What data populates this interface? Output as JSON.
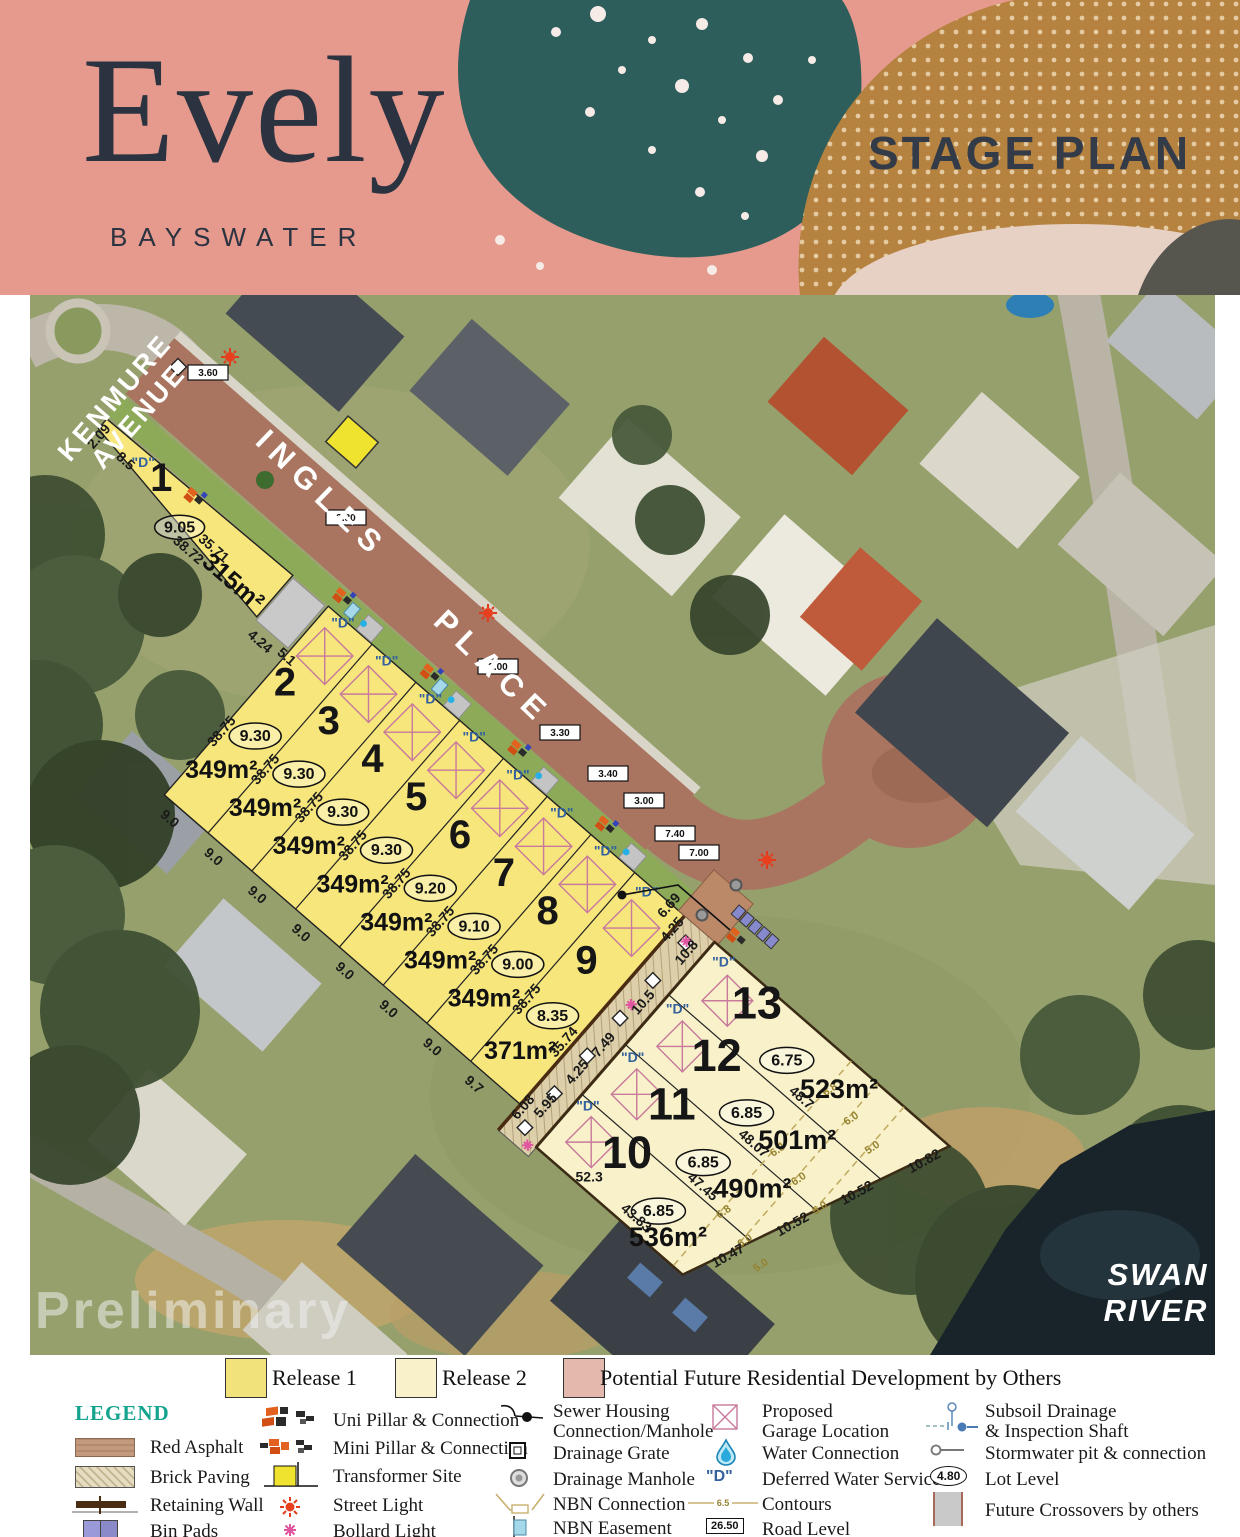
{
  "header": {
    "brand": "Evely",
    "suburb": "BAYSWATER",
    "plan_title": "STAGE PLAN"
  },
  "map": {
    "streets": {
      "kenmure_l1": "KENMURE",
      "kenmure_l2": "AVENUE",
      "ingles": "INGLES",
      "place": "PLACE"
    },
    "river_l1": "SWAN",
    "river_l2": "RIVER",
    "watermark": "Preliminary",
    "dws": "\"D\"",
    "road_levels": [
      "3.60",
      "3.30",
      "3.00",
      "3.30",
      "3.40",
      "3.00",
      "7.40",
      "7.00"
    ],
    "contours": [
      "6.8",
      "6.0",
      "5.0"
    ],
    "lots": [
      {
        "n": "1",
        "area": "315m²",
        "level": "9.05",
        "d1": "2.09",
        "d2": "8.5",
        "d3": "35.71",
        "d4": "38.72"
      },
      {
        "n": "2",
        "area": "349m²",
        "level": "9.30",
        "side": "38.75",
        "rear": "9.0"
      },
      {
        "n": "3",
        "area": "349m²",
        "level": "9.30",
        "side": "38.75",
        "rear": "9.0"
      },
      {
        "n": "4",
        "area": "349m²",
        "level": "9.30",
        "side": "38.75",
        "rear": "9.0"
      },
      {
        "n": "5",
        "area": "349m²",
        "level": "9.30",
        "side": "38.75",
        "rear": "9.0"
      },
      {
        "n": "6",
        "area": "349m²",
        "level": "9.20",
        "side": "38.75",
        "rear": "9.0"
      },
      {
        "n": "7",
        "area": "349m²",
        "level": "9.10",
        "side": "38.75",
        "rear": "9.0"
      },
      {
        "n": "8",
        "area": "349m²",
        "level": "9.00",
        "side": "38.75",
        "rear": "9.0"
      },
      {
        "n": "9",
        "area": "371m²",
        "level": "8.35",
        "side": "38.75",
        "side2": "35.74",
        "rear": "9.7"
      },
      {
        "n": "10",
        "area": "536m²",
        "level": "6.85",
        "len": "43.83",
        "end": "10.47",
        "side": "52.3"
      },
      {
        "n": "11",
        "area": "490m²",
        "level": "6.85",
        "len": "47.45",
        "end": "10.52"
      },
      {
        "n": "12",
        "area": "501m²",
        "level": "6.85",
        "len": "48.07",
        "end": "10.52"
      },
      {
        "n": "13",
        "area": "523m²",
        "level": "6.75",
        "len": "48.7",
        "end": "10.82",
        "front": "10.8"
      }
    ],
    "dims": {
      "cross1": "4.24",
      "cross2": "5.1",
      "j1": "6.69",
      "j2": "4.25",
      "acc1": "10.5",
      "acc2": "7.49",
      "acc3": "4.25",
      "acc4": "5.95",
      "acc5": "6.08"
    }
  },
  "legend": {
    "title": "LEGEND",
    "releases": [
      {
        "label": "Release 1"
      },
      {
        "label": "Release 2"
      },
      {
        "label": "Potential Future Residential Development by Others"
      }
    ],
    "items": {
      "red_asphalt": "Red Asphalt",
      "brick_paving": "Brick Paving",
      "retaining_wall": "Retaining Wall",
      "bin_pads": "Bin Pads",
      "uni_pillar": "Uni Pillar & Connection",
      "mini_pillar": "Mini Pillar & Connection",
      "transformer": "Transformer Site",
      "street_light": "Street Light",
      "bollard_light": "Bollard Light",
      "sewer_l1": "Sewer Housing",
      "sewer_l2": "Connection/Manhole",
      "drainage_grate": "Drainage Grate",
      "drainage_manhole": "Drainage Manhole",
      "nbn_connection": "NBN Connection",
      "nbn_easement": "NBN Easement",
      "garage_l1": "Proposed",
      "garage_l2": "Garage Location",
      "water_connection": "Water Connection",
      "deferred_water": "Deferred Water Service",
      "contours": "Contours",
      "road_level": "Road Level",
      "subsoil_l1": "Subsoil Drainage",
      "subsoil_l2": "& Inspection Shaft",
      "stormwater": "Stormwater pit & connection",
      "lot_level": "Lot Level",
      "future_crossovers": "Future Crossovers by others",
      "dws_sample": "\"D\"",
      "contour_sample": "6.5",
      "road_level_sample": "26.50",
      "lot_level_sample": "4.80"
    }
  },
  "colors": {
    "release1": "#f6e67c",
    "release2": "#f8f1c9",
    "release3": "#e4b8ad",
    "red_asphalt": "#a97460",
    "header_pink": "#e59a8d",
    "header_teal": "#2d5e5b",
    "header_brown": "#b5823f"
  }
}
